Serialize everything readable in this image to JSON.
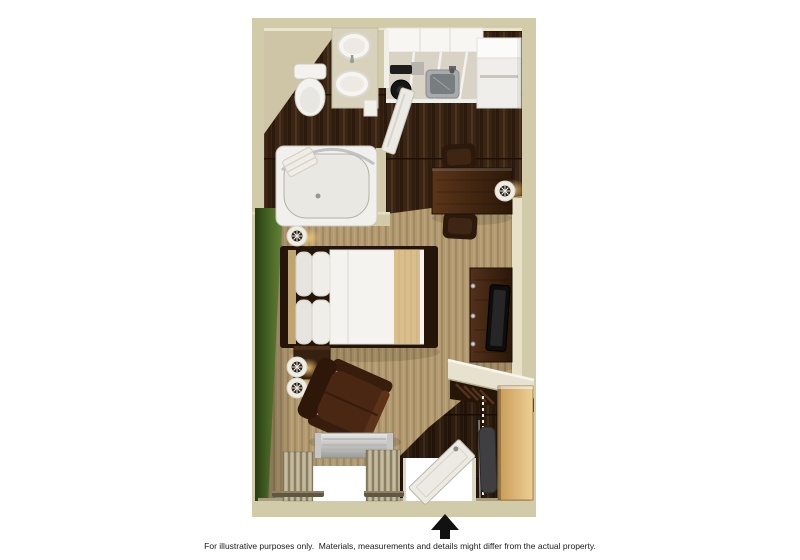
{
  "floorplan": {
    "disclaimer": "For illustrative purposes only.  Materials, measurements and details might differ from the actual property.",
    "entrance_marker": "up-arrow",
    "rooms": [
      "bathroom",
      "kitchen",
      "sleeping-area",
      "living-area",
      "closet",
      "entry"
    ],
    "items": [
      "toilet",
      "vanity-sink",
      "bathtub",
      "shower-rod",
      "towel",
      "bathroom-door",
      "kitchen-counter",
      "stove-cooktop",
      "kitchen-sink",
      "refrigerator",
      "table",
      "table-chair-upper",
      "table-chair-lower",
      "desk-wall-lamp",
      "queen-bed",
      "pillows",
      "bed-runner",
      "nightstand",
      "headboard-wall-lamp",
      "nightstand-wall-lamp-1",
      "nightstand-wall-lamp-2",
      "tv-stand",
      "television",
      "closet-shelf",
      "clothes-hangers",
      "wardrobe-cabinet",
      "ironing-board",
      "armchair",
      "ptac-air-conditioner",
      "window",
      "curtains",
      "curtain-rods",
      "entry-door",
      "entrance-arrow"
    ],
    "colors": {
      "background": "#ffffff",
      "wall": "#d2cbaa",
      "wall_face": "#e8e1c8",
      "wood_floor": "#3a2414",
      "carpet": "#b39a6e",
      "accent_wall_green": "#46611f",
      "fixtures_white": "#f2f1ed",
      "furniture_walnut": "#3c2312",
      "wardrobe_maple": "#d3a968",
      "metal_silver": "#b9b9b9",
      "arrow_black": "#111111",
      "text_black": "#1a1a1a"
    }
  }
}
